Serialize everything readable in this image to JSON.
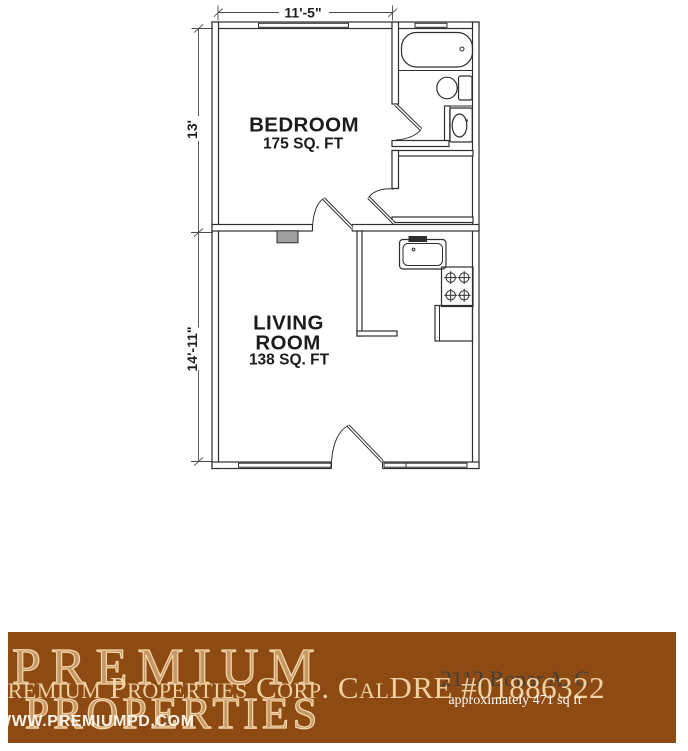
{
  "floor_plan": {
    "dim_width_top": "11'-5\"",
    "dim_height_bedroom": "13'",
    "dim_height_living": "14'-11\"",
    "bedroom_name": "BEDROOM",
    "bedroom_area": "175 SQ. FT",
    "living_name_line1": "LIVING",
    "living_name_line2": "ROOM",
    "living_area": "138 SQ. FT",
    "fixtures": [
      "bathtub",
      "toilet",
      "vanity-sink",
      "kitchen-sink",
      "stove",
      "refrigerator-counter",
      "wall-heater"
    ],
    "line_color": "#2e2e2e"
  },
  "banner": {
    "watermark_line1": "PREMIUM",
    "watermark_line2": "PROPERTIES",
    "company_line": "Premium Properties Corp. CalDRE #01886322",
    "address": "2112 Bonar A, C",
    "area_text": "approximately 471 sq ft",
    "website": "WWW.PREMIUMPD.COM",
    "colors": {
      "background": "#8d4a12",
      "cream": "#f6d8ab",
      "white": "#ffffff",
      "address_text": "#44403a"
    }
  }
}
